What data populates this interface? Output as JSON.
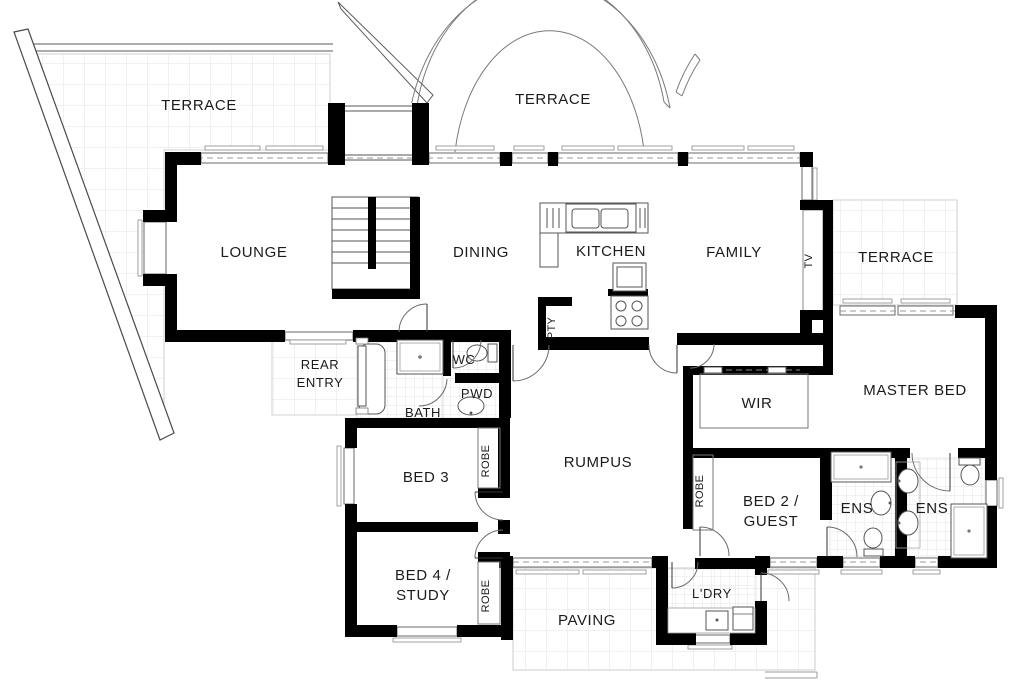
{
  "plan": {
    "rooms": {
      "terrace_nw": "TERRACE",
      "terrace_n": "TERRACE",
      "terrace_e": "TERRACE",
      "lounge": "LOUNGE",
      "dining": "DINING",
      "kitchen": "KITCHEN",
      "family": "FAMILY",
      "pantry": "PTY",
      "tv_nook": "TV",
      "rear_entry_line1": "REAR",
      "rear_entry_line2": "ENTRY",
      "wc": "WC",
      "powder": "PWD",
      "bath": "BATH",
      "bed3": "BED 3",
      "bed3_robe": "ROBE",
      "bed4_line1": "BED 4 /",
      "bed4_line2": "STUDY",
      "bed4_robe": "ROBE",
      "rumpus": "RUMPUS",
      "wir": "WIR",
      "master_bed": "MASTER BED",
      "bed2_robe": "ROBE",
      "bed2_line1": "BED 2 /",
      "bed2_line2": "GUEST",
      "ensuite_left": "ENS",
      "ensuite_right": "ENS",
      "laundry": "L'DRY",
      "paving": "PAVING"
    },
    "colors": {
      "wall": "#000000",
      "thin_line": "#666666",
      "tile_line": "#e2e2e2",
      "label": "#1b1b1b"
    }
  }
}
